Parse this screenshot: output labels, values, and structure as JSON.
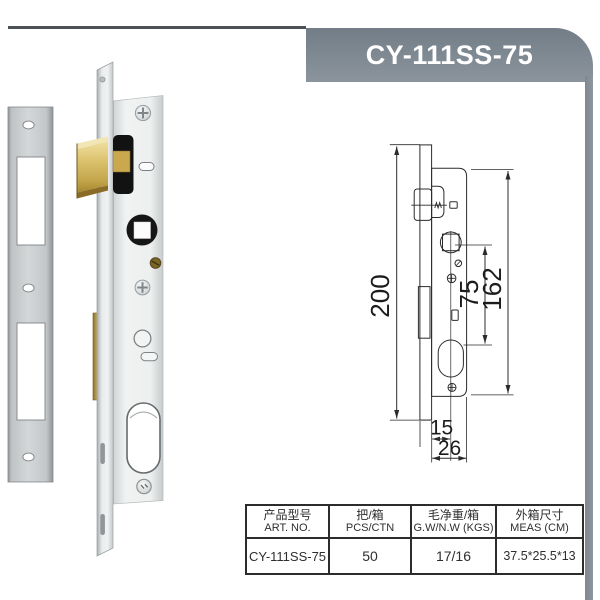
{
  "banner": {
    "model": "CY-111SS-75"
  },
  "colors": {
    "banner_gray": "#808a93",
    "brass": "#d4b75f",
    "plate_gray": "#c9cdcf",
    "line": "#2b2b2b"
  },
  "drawing": {
    "dim_faceplate_height": "200",
    "dim_case_height": "162",
    "dim_center_distance": "75",
    "dim_backset": "15",
    "dim_case_width": "26"
  },
  "table": {
    "headers": [
      {
        "cn": "产品型号",
        "en": "ART. NO."
      },
      {
        "cn": "把/箱",
        "en": "PCS/CTN"
      },
      {
        "cn": "毛净重/箱",
        "en": "G.W/N.W (KGS)"
      },
      {
        "cn": "外箱尺寸",
        "en": "MEAS (CM)"
      }
    ],
    "row": [
      "CY-111SS-75",
      "50",
      "17/16",
      "37.5*25.5*13"
    ]
  }
}
